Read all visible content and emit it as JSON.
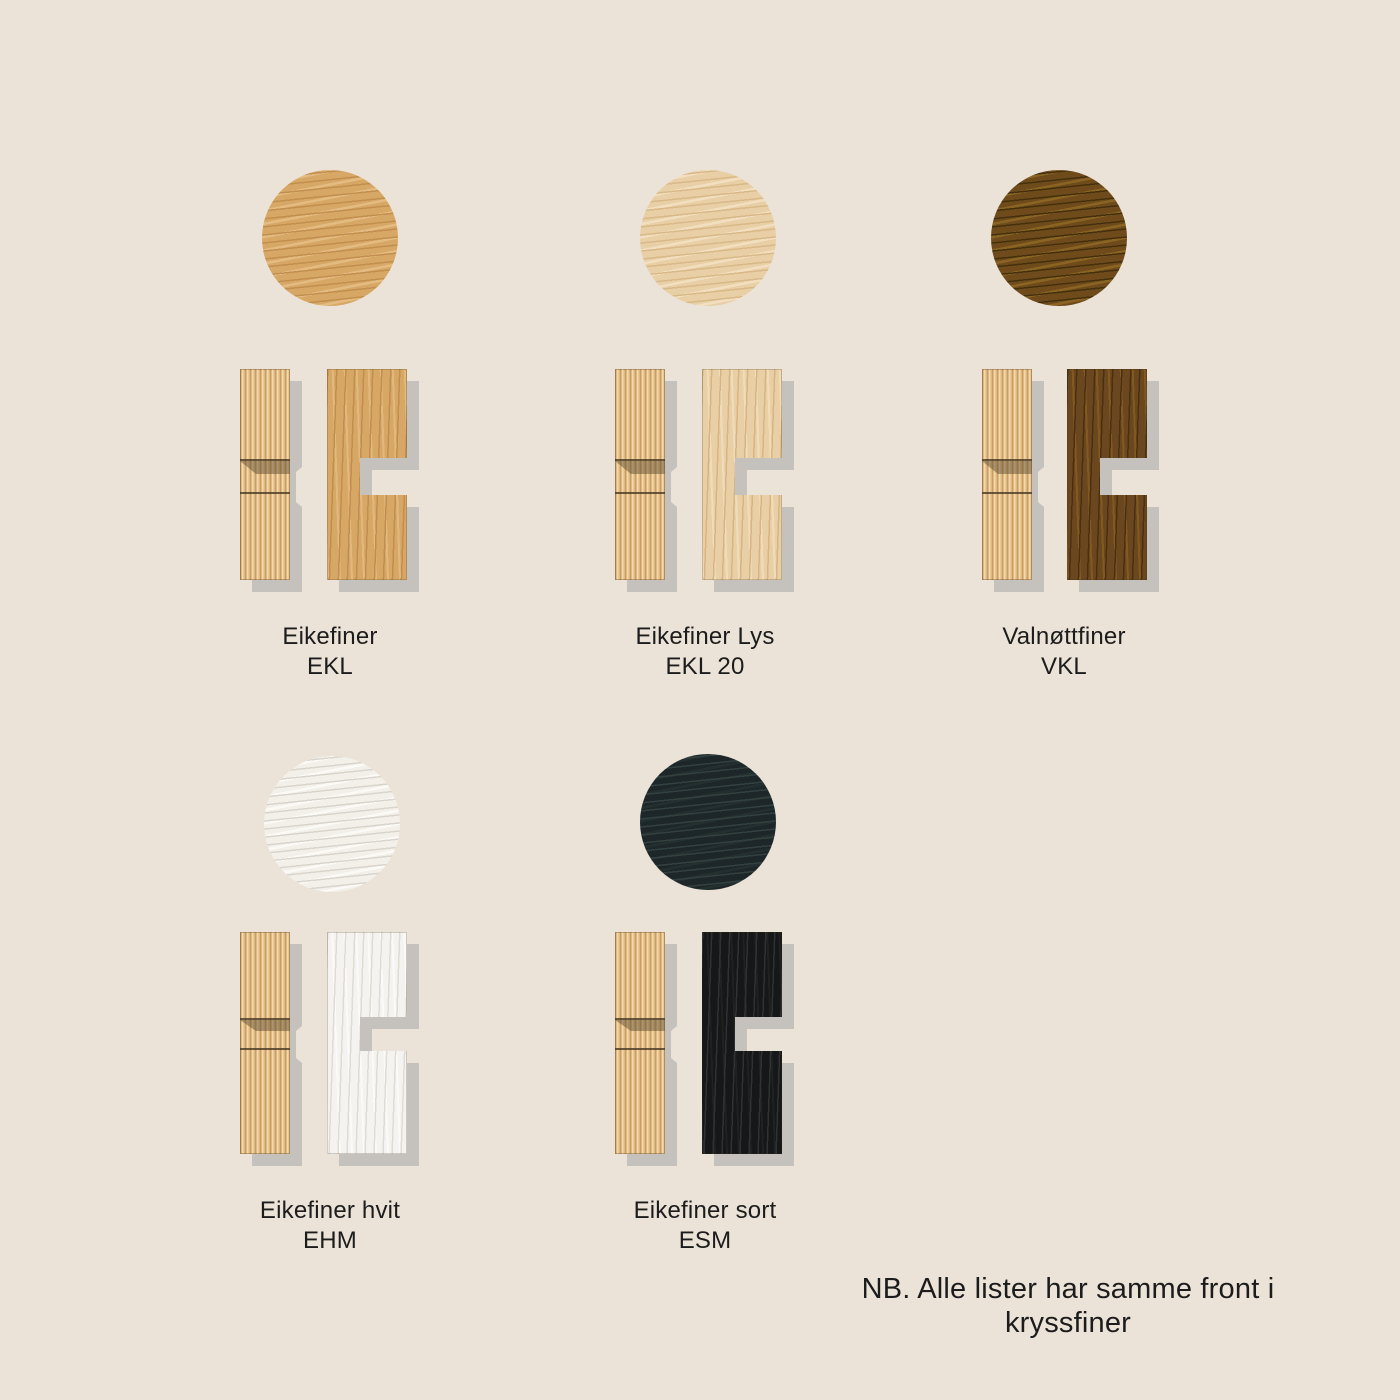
{
  "page": {
    "background": "#ece3d8",
    "shadow_color": "#c5c1bc",
    "text_color": "#1c1c1c",
    "footnote": "NB. Alle lister har samme front i kryssfiner"
  },
  "flute_colors": {
    "light": "#f0d9b0",
    "mid": "#e0b77c",
    "dark": "#c99e62"
  },
  "swatches": [
    {
      "name": "Eikefiner",
      "code": "EKL",
      "colors": {
        "base": "#d7a766",
        "streak": "#c18e4e",
        "light": "#e2b87d"
      },
      "circle_colors": {
        "base": "#d7a765",
        "streak": "#c28f4f",
        "light": "#e4bb80"
      }
    },
    {
      "name": "Eikefiner Lys",
      "code": "EKL 20",
      "colors": {
        "base": "#e9cfa5",
        "streak": "#d6b483",
        "light": "#f1dcba"
      },
      "circle_colors": {
        "base": "#e9cfa6",
        "streak": "#d8b988",
        "light": "#f2dfbf"
      }
    },
    {
      "name": "Valnøttfiner",
      "code": "VKL",
      "colors": {
        "base": "#6b4720",
        "streak": "#4a3010",
        "light": "#82591f"
      },
      "circle_colors": {
        "base": "#6f4b1b",
        "streak": "#45300e",
        "light": "#8a6423"
      }
    },
    {
      "name": "Eikefiner hvit",
      "code": "EHM",
      "colors": {
        "base": "#f5f3ef",
        "streak": "#e0dcd4",
        "light": "#fbfaf8"
      },
      "circle_colors": {
        "base": "#f3f0ea",
        "streak": "#d9d5cd",
        "light": "#fbfaf7"
      }
    },
    {
      "name": "Eikefiner sort",
      "code": "ESM",
      "colors": {
        "base": "#161718",
        "streak": "#2e3230",
        "light": "#1f2221"
      },
      "circle_colors": {
        "base": "#1d272a",
        "streak": "#32403f",
        "light": "#24302f"
      }
    }
  ]
}
